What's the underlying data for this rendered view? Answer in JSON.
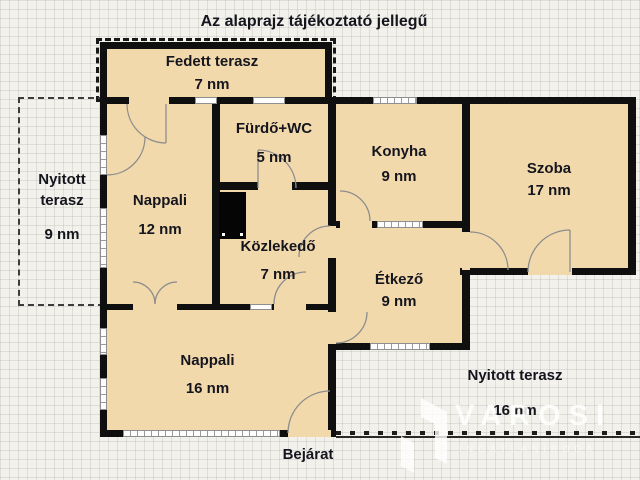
{
  "title": "Az alaprajz tájékoztató jellegű",
  "rooms": [
    {
      "name": "Fedett terasz",
      "area": "7 nm"
    },
    {
      "name": "Nyitott terasz",
      "area": "9 nm"
    },
    {
      "name": "Nappali",
      "area": "12 nm"
    },
    {
      "name": "Fürdő+WC",
      "area": "5 nm"
    },
    {
      "name": "Közlekedő",
      "area": "7 nm"
    },
    {
      "name": "Konyha",
      "area": "9 nm"
    },
    {
      "name": "Étkező",
      "area": "9 nm"
    },
    {
      "name": "Szoba",
      "area": "17 nm"
    },
    {
      "name": "Nappali",
      "area": "16 nm"
    },
    {
      "name": "Nyitott terasz",
      "area": "16 nm"
    }
  ],
  "entrance_label": "Bejárat",
  "watermark": {
    "brand": "VAROSI",
    "tagline": "INGATLANIRODA"
  },
  "colors": {
    "room_fill": "#f2d9ac",
    "wall": "#0f0f0f",
    "background": "#f2f1ec",
    "label_text": "#15151e"
  }
}
